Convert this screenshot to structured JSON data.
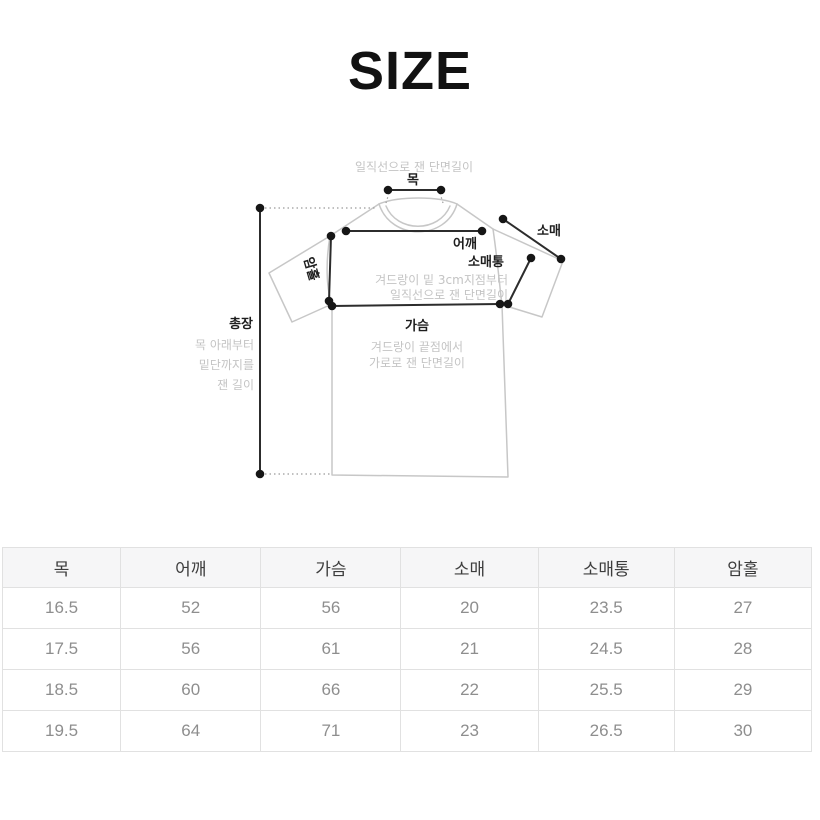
{
  "title": "SIZE",
  "diagram": {
    "labels": {
      "neck": "목",
      "shoulder": "어깨",
      "sleeve": "소매",
      "sleeve_width": "소매통",
      "chest": "가슴",
      "armhole": "암홀",
      "total_length": "총장"
    },
    "notes": {
      "neck_measure": "일직선으로 잰 단면길이",
      "sleeve_width_line1": "겨드랑이 밑 3cm지점부터",
      "sleeve_width_line2": "일직선으로 잰 단면길이",
      "chest_line1": "겨드랑이 끝점에서",
      "chest_line2": "가로로 잰 단면길이",
      "total_length_line1": "목 아래부터",
      "total_length_line2": "밑단까지를",
      "total_length_line3": "잰 길이"
    }
  },
  "size_table": {
    "headers": [
      "목",
      "어깨",
      "가슴",
      "소매",
      "소매통",
      "암홀"
    ],
    "rows": [
      [
        "16.5",
        "52",
        "56",
        "20",
        "23.5",
        "27"
      ],
      [
        "17.5",
        "56",
        "61",
        "21",
        "24.5",
        "28"
      ],
      [
        "18.5",
        "60",
        "66",
        "22",
        "25.5",
        "29"
      ],
      [
        "19.5",
        "64",
        "71",
        "23",
        "26.5",
        "30"
      ]
    ]
  },
  "colors": {
    "measure_line": "#2c2c2c",
    "garment_outline": "#c7c7c7",
    "note_text": "#c4c4c4",
    "label_text": "#1e1e1e",
    "table_border": "#e1e1e1",
    "table_header_bg": "#f6f6f7",
    "table_header_text": "#3d3d3d",
    "table_value_text": "#8e8e8e"
  }
}
